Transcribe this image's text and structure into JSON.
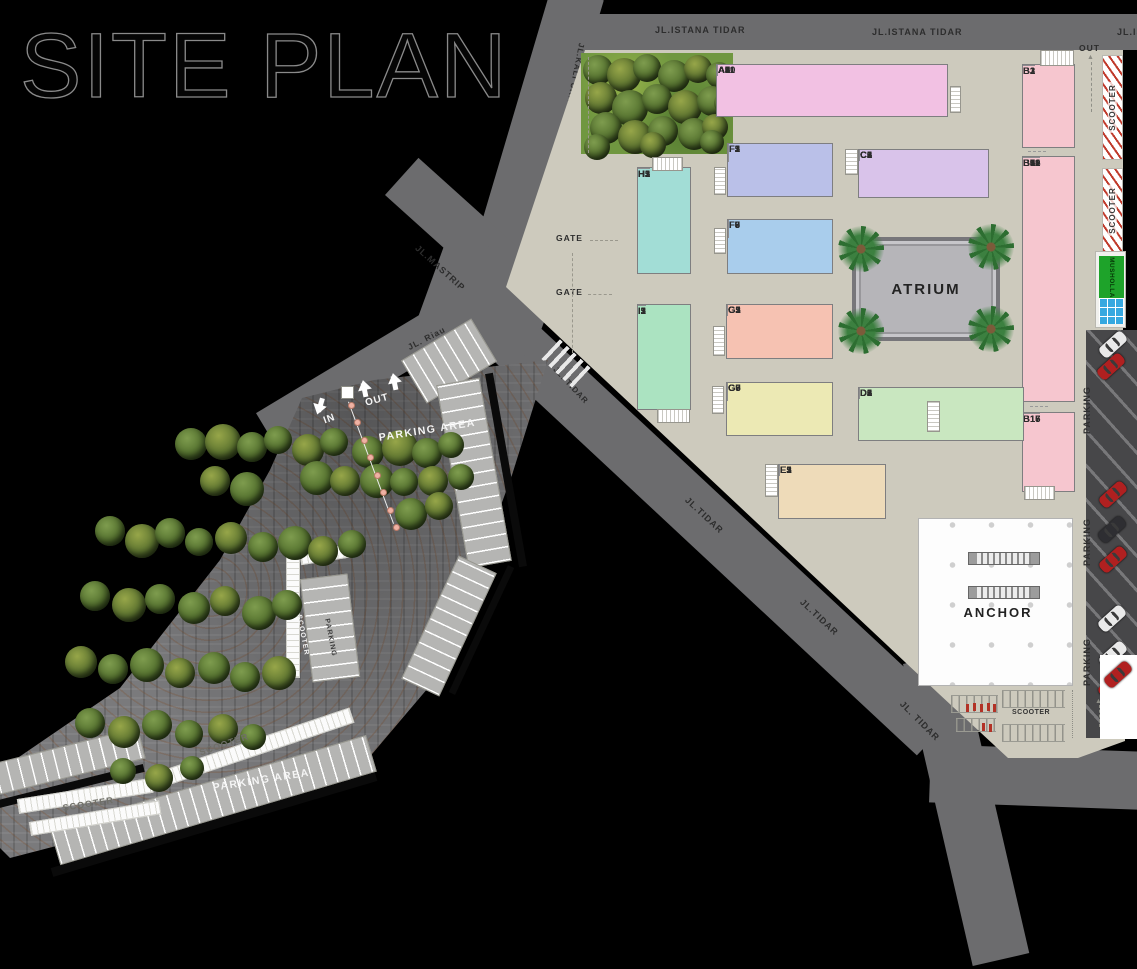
{
  "page": {
    "title": "SITE PLAN"
  },
  "roads": {
    "istana_label_1": "JL.ISTANA TIDAR",
    "istana_label_2": "JL.ISTANA TIDAR",
    "istana_label_3": "JL.IS",
    "kali_urang_label": "JL.KALI URANG",
    "mastrip_label": "JL.MASTRIP",
    "riau_label": "JL. Riau",
    "tidar_label_1": "JL. TIDAR",
    "tidar_label_2": "JL.TIDAR",
    "tidar_label_3": "JL.TIDAR",
    "tidar_label_4": "JL. TIDAR",
    "gate_label_1": "GATE",
    "gate_label_2": "GATE",
    "out_label": "OUT"
  },
  "site": {
    "atrium_label": "ATRIUM",
    "anchor_label": "ANCHOR",
    "musholla_label": "MUSHOLLA",
    "scooter_strip_label_1": "SCOOTER",
    "scooter_strip_label_2": "SCOOTER",
    "scooter_rack_label": "SCOOTER",
    "parking_side_labels": [
      "PARKING",
      "PARKING",
      "PARKING"
    ]
  },
  "clusters": {
    "a": {
      "color": "#f2c1e3",
      "units": [
        "A1",
        "A2",
        "A3",
        "A5",
        "A6",
        "A7",
        "A8",
        "A9",
        "A10",
        "A11"
      ]
    },
    "b_top": {
      "color": "#f6c6cf",
      "units": [
        "B1",
        "B2",
        "B3"
      ]
    },
    "b_mid": {
      "color": "#f6c6cf",
      "units": [
        "B5",
        "B6",
        "B7",
        "B8",
        "B9",
        "B10",
        "B11",
        "B12",
        "B14"
      ]
    },
    "b_bot": {
      "color": "#f6c6cf",
      "units": [
        "B15",
        "B16",
        "B17"
      ]
    },
    "c": {
      "color": "#d9c3ea",
      "units": [
        "C1",
        "C2",
        "C3",
        "C5",
        "C6"
      ]
    },
    "f_top": {
      "color": "#bac0e8",
      "units": [
        "F1",
        "F2",
        "F3",
        "F5"
      ]
    },
    "f_bot": {
      "color": "#a9cdec",
      "units": [
        "F6",
        "F7",
        "F8",
        "F9"
      ]
    },
    "h": {
      "color": "#a2ddd6",
      "units": [
        "H1",
        "H2",
        "H3",
        "H5"
      ]
    },
    "i": {
      "color": "#abe3c1",
      "units": [
        "I1",
        "I2",
        "I3",
        "I5"
      ]
    },
    "g_top": {
      "color": "#f6c2b2",
      "units": [
        "G1",
        "G2",
        "G3",
        "G5"
      ]
    },
    "g_bot": {
      "color": "#ece9b4",
      "units": [
        "G6",
        "G7",
        "G8",
        "G9"
      ]
    },
    "d": {
      "color": "#c9e7c0",
      "units": [
        "D1",
        "D2",
        "D3",
        "D5",
        "D6"
      ]
    },
    "e": {
      "color": "#eedbb9",
      "units": [
        "E1",
        "E2",
        "E3",
        "E5"
      ]
    }
  },
  "parking_area": {
    "title_1": "PARKING AREA",
    "title_2": "PARKING AREA",
    "in_label": "IN",
    "out_label": "OUT",
    "lane_label_1": "SCOOTER",
    "lane_label_2": "SCOOTER",
    "inner_scooter_label": "SCOOTER",
    "inner_parking_label": "PARKING"
  }
}
